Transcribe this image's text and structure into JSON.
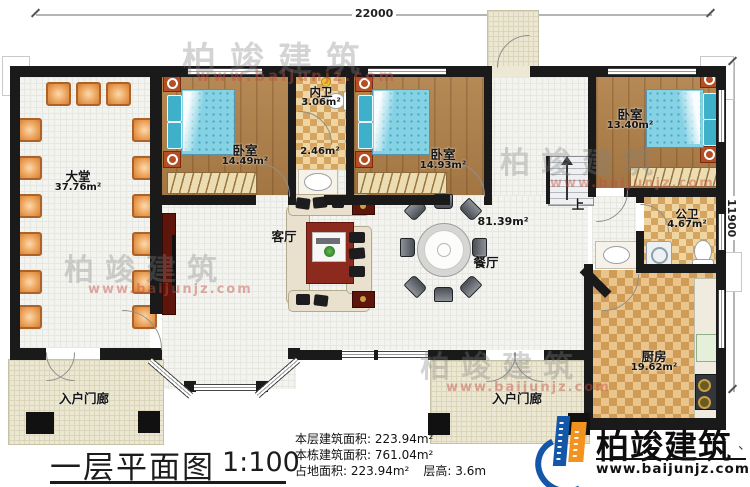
{
  "plan": {
    "dimensions": {
      "top": "22000",
      "right": "11900"
    },
    "rooms": {
      "hall": {
        "name": "大堂",
        "area": "37.76m²"
      },
      "bedroom1": {
        "name": "卧室",
        "area": "14.49m²"
      },
      "inner_bath": {
        "name": "内卫",
        "area": "3.06m²"
      },
      "corridor": {
        "area": "2.46m²"
      },
      "bedroom2": {
        "name": "卧室",
        "area": "14.93m²"
      },
      "bedroom3": {
        "name": "卧室",
        "area": "13.40m²"
      },
      "public_bath": {
        "name": "公卫",
        "area": "4.67m²"
      },
      "open_area": {
        "area": "81.39m²"
      },
      "living": {
        "name": "客厅"
      },
      "dining": {
        "name": "餐厅"
      },
      "kitchen": {
        "name": "厨房",
        "area": "19.62m²"
      },
      "porch_left": {
        "name": "入户门廊"
      },
      "porch_right": {
        "name": "入户门廊"
      },
      "stairs": {
        "up": "上"
      }
    },
    "title": {
      "text": "一层平面图",
      "scale": "1:100"
    },
    "stats": {
      "l1": {
        "label": "本层建筑面积:",
        "value": "223.94m²"
      },
      "l2": {
        "label": "本栋建筑面积:",
        "value": "761.04m²"
      },
      "l3": {
        "label": "占地面积:",
        "value": "223.94m²"
      },
      "l4": {
        "label": "层高:",
        "value": "3.6m"
      }
    },
    "logo": {
      "brand": "柏竣建筑",
      "site": "www.baijunjz.com",
      "mark": "、"
    },
    "watermark": {
      "brand": "柏竣建筑",
      "site": "www.baijunjz.com"
    },
    "colors": {
      "wall": "#1a1a1a",
      "wood_floor": "#b08048",
      "tile_checker": "#d5a45f",
      "bed_blue": "#85d2e4",
      "logo_blue": "#1456a8",
      "logo_orange": "#f3931f",
      "watermark_red": "#c5473f",
      "accent_dark_red": "#5e150c"
    }
  }
}
